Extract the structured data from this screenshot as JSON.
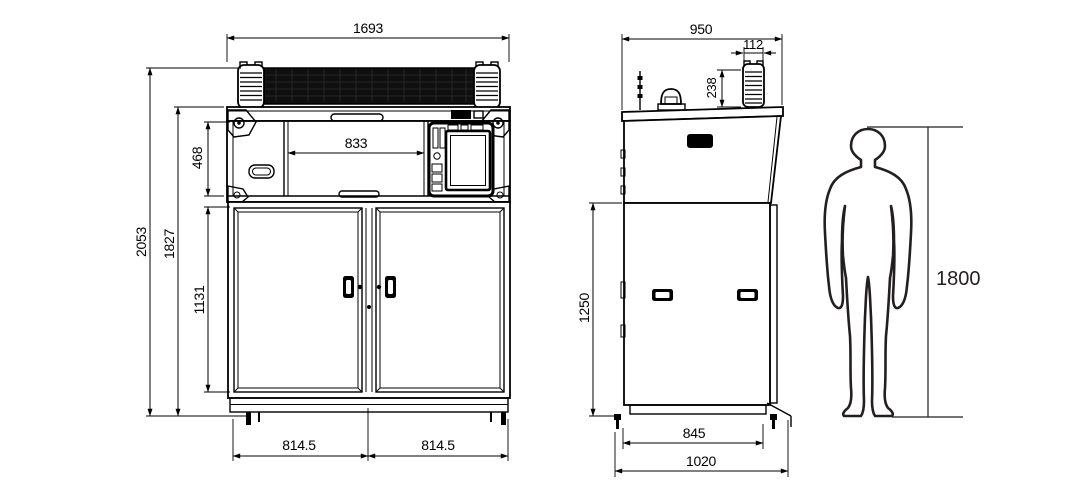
{
  "colors": {
    "line": "#000000",
    "human_outline": "#231f20",
    "roller_bar_fill": "#0f0f0f",
    "background": "#ffffff"
  },
  "dims": {
    "front_total_width": "1693",
    "front_inner_width": "833",
    "front_top_section_height": "468",
    "front_total_height": "2053",
    "front_body_height": "1827",
    "front_door_height": "1131",
    "front_left_door_width": "814.5",
    "front_right_door_width": "814.5",
    "side_total_depth": "950",
    "side_spool_width": "112",
    "side_spool_height": "238",
    "side_body_height": "1250",
    "side_base_inner_depth": "845",
    "side_base_outer_depth": "1020",
    "human_height": "1800"
  }
}
